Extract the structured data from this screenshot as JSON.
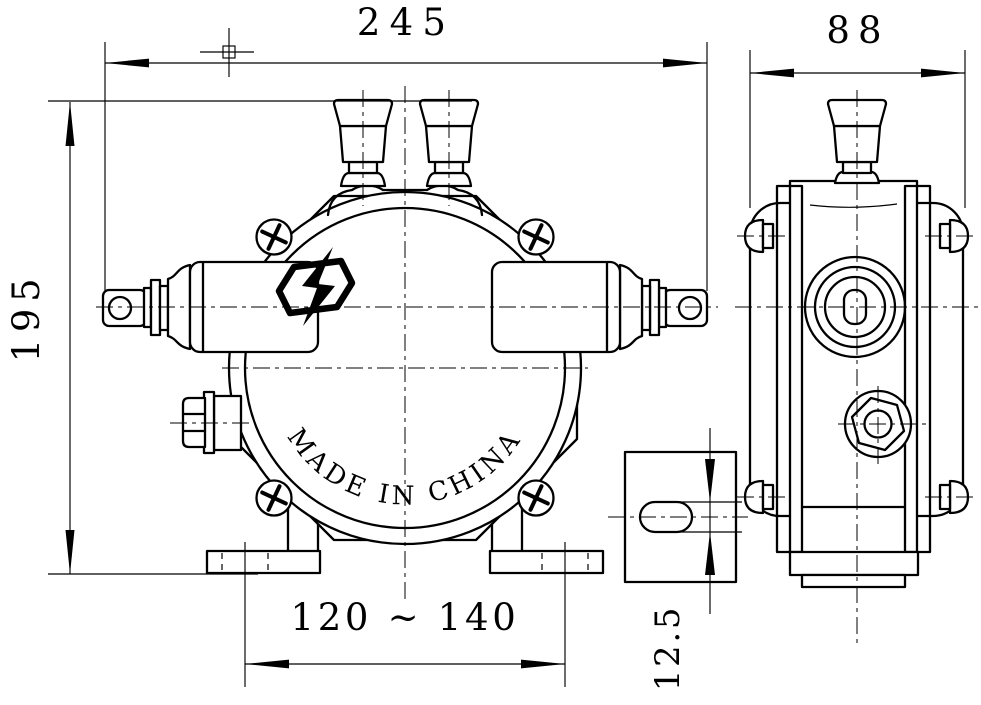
{
  "canvas": {
    "background": "#ffffff",
    "line_color": "#000000"
  },
  "dimensions": {
    "overall_width": "245",
    "overall_height": "195",
    "depth": "88",
    "mounting_hole_spacing": "120 ~ 140",
    "foot_slot_width": "12.5"
  },
  "front_view": {
    "marking_arc_text": "MADE IN CHINA"
  },
  "icons": {
    "logo": "explosion-proof-lightning-icon"
  }
}
